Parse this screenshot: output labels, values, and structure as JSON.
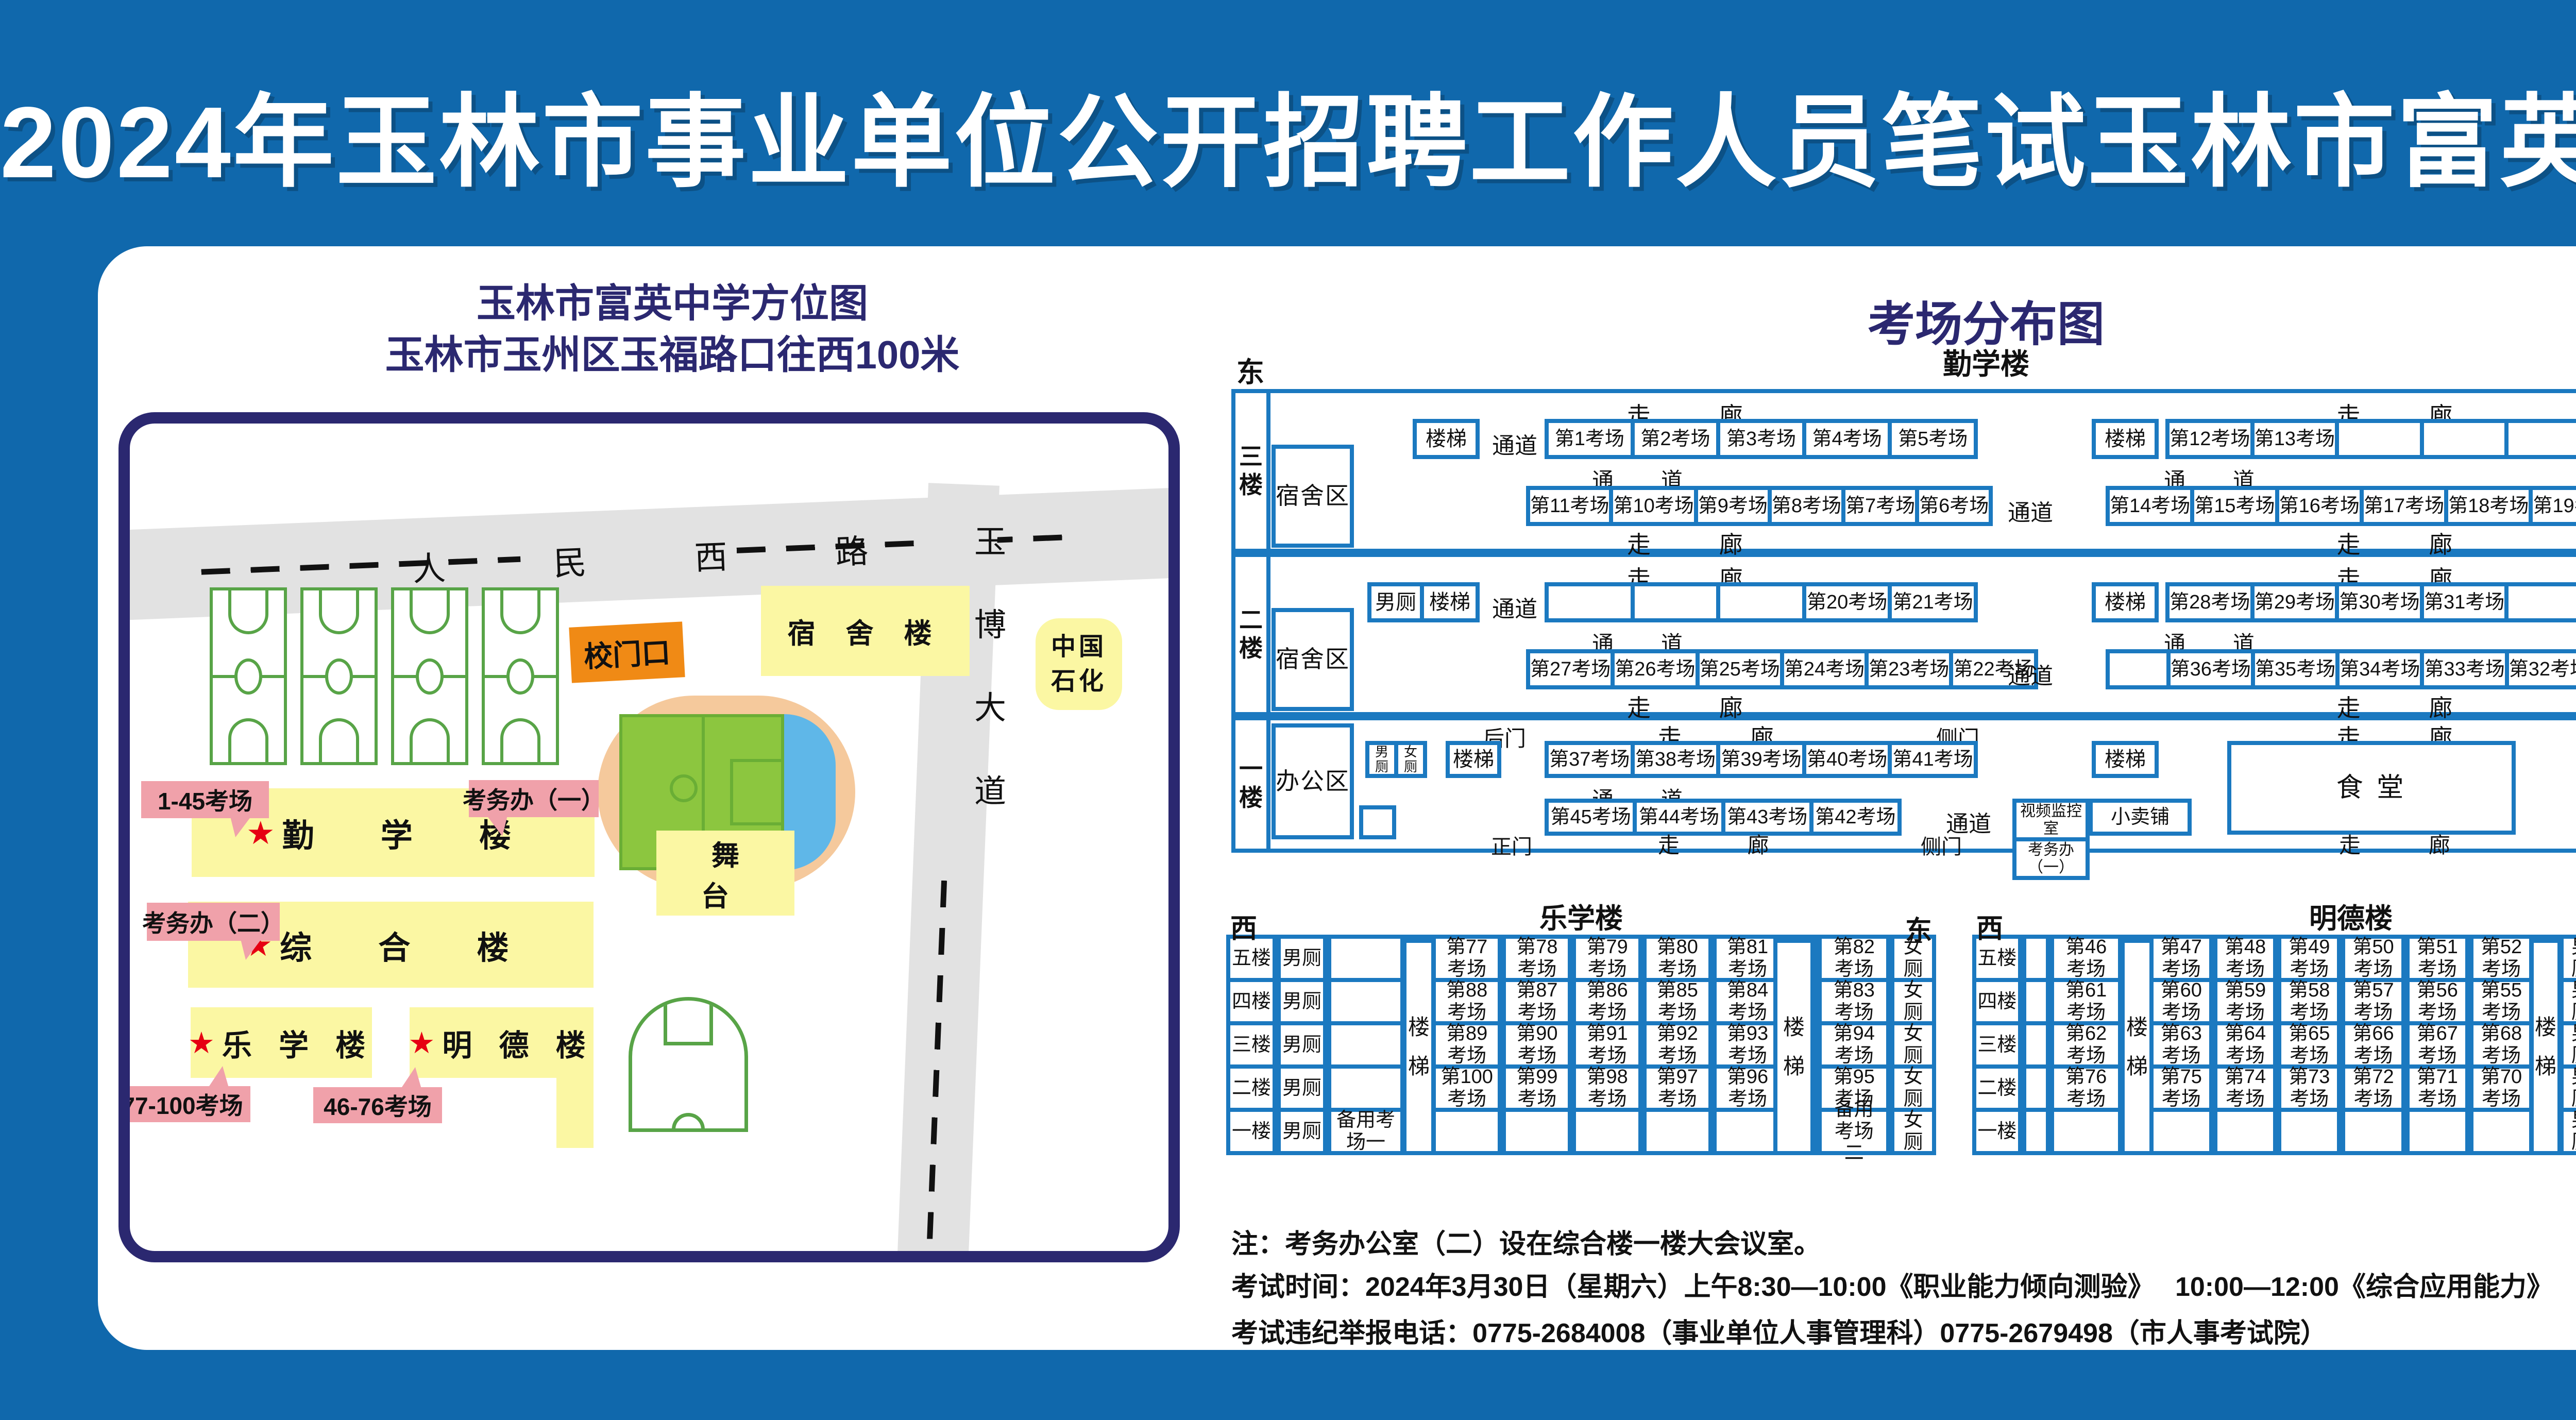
{
  "title": "2024年玉林市事业单位公开招聘工作人员笔试玉林市富英中学考点考场示意图",
  "left_map": {
    "title_line1": "玉林市富英中学方位图",
    "title_line2": "玉林市玉州区玉福路口往西100米",
    "road_ew": "人 民 西 路",
    "road_ns": "玉博大道",
    "gate": "校门口",
    "dorm": "宿 舍 楼",
    "sinopec": "中国石化",
    "stage": "舞 台",
    "star": "★",
    "buildings": {
      "qinxue": "勤 学 楼",
      "zonghe": "综 合 楼",
      "lexue": "乐 学 楼",
      "mingde": "明 德 楼"
    },
    "callouts": {
      "qinxue_rooms": "1-45考场",
      "kwb1": "考务办（一）",
      "kwb2": "考务办（二）",
      "lexue_rooms": "77-100考场",
      "mingde_rooms": "46-76考场"
    }
  },
  "plan": {
    "title": "考场分布图",
    "building": "勤学楼",
    "east": "东",
    "west": "西",
    "corridor": "走 廊",
    "passage": "通 道",
    "passage_small": "通道",
    "stairs": "楼梯",
    "male": "男厕",
    "female": "女厕",
    "f3": {
      "label": "三楼",
      "zone": "宿舍区",
      "top_left": [
        "第1考场",
        "第2考场",
        "第3考场",
        "第4考场",
        "第5考场"
      ],
      "top_right": [
        "第12考场",
        "第13考场",
        "",
        "",
        ""
      ],
      "bottom_left": [
        "第11考场",
        "第10考场",
        "第9考场",
        "第8考场",
        "第7考场",
        "第6考场"
      ],
      "bottom_right": [
        "第14考场",
        "第15考场",
        "第16考场",
        "第17考场",
        "第18考场",
        "第19考场"
      ]
    },
    "f2": {
      "label": "二楼",
      "zone": "宿舍区",
      "top_left": [
        "",
        "",
        "",
        "第20考场",
        "第21考场"
      ],
      "top_right": [
        "第28考场",
        "第29考场",
        "第30考场",
        "第31考场",
        ""
      ],
      "bottom_left": [
        "第27考场",
        "第26考场",
        "第25考场",
        "第24考场",
        "第23考场",
        "第22考场"
      ],
      "bottom_right": [
        "",
        "第36考场",
        "第35考场",
        "第34考场",
        "第33考场",
        "第32考场"
      ]
    },
    "f1": {
      "label": "一楼",
      "zone": "办公区",
      "top": [
        "第37考场",
        "第38考场",
        "第39考场",
        "第40考场",
        "第41考场"
      ],
      "bottom": [
        "第45考场",
        "第44考场",
        "第43考场",
        "第42考场"
      ],
      "canteen": "食  堂",
      "monitor": "视频监控室",
      "kwb1": "考务办（一）",
      "shop": "小卖铺",
      "back_door": "后门",
      "side_door": "侧门",
      "main_door": "正门"
    }
  },
  "tables": {
    "lexue": {
      "west": "西",
      "east": "东",
      "name": "乐学楼",
      "stairs": "楼梯",
      "rows": [
        {
          "floor": "五楼",
          "male": "男厕",
          "extra": "",
          "r0": "第77考场",
          "r1": "第78考场",
          "r2": "第79考场",
          "r3": "第80考场",
          "r4": "第81考场",
          "east": "第82考场",
          "female": "女厕"
        },
        {
          "floor": "四楼",
          "male": "男厕",
          "extra": "",
          "r0": "第88考场",
          "r1": "第87考场",
          "r2": "第86考场",
          "r3": "第85考场",
          "r4": "第84考场",
          "east": "第83考场",
          "female": "女厕"
        },
        {
          "floor": "三楼",
          "male": "男厕",
          "extra": "",
          "r0": "第89考场",
          "r1": "第90考场",
          "r2": "第91考场",
          "r3": "第92考场",
          "r4": "第93考场",
          "east": "第94考场",
          "female": "女厕"
        },
        {
          "floor": "二楼",
          "male": "男厕",
          "extra": "",
          "r0": "第100考场",
          "r1": "第99考场",
          "r2": "第98考场",
          "r3": "第97考场",
          "r4": "第96考场",
          "east": "第95考场",
          "female": "女厕"
        },
        {
          "floor": "一楼",
          "male": "男厕",
          "extra": "备用考场一",
          "r0": "",
          "r1": "",
          "r2": "",
          "r3": "",
          "r4": "",
          "east": "备用考场二",
          "female": "女厕"
        }
      ]
    },
    "mingde": {
      "west": "西",
      "east": "东",
      "name": "明德楼",
      "stairs": "楼梯",
      "rows": [
        {
          "floor": "五楼",
          "west_cell": "第46考场",
          "r0": "第47考场",
          "r1": "第48考场",
          "r2": "第49考场",
          "r3": "第50考场",
          "r4": "第51考场",
          "r5": "第52考场",
          "male": "男厕",
          "female": "女厕",
          "east": "第53考场"
        },
        {
          "floor": "四楼",
          "west_cell": "第61考场",
          "r0": "第60考场",
          "r1": "第59考场",
          "r2": "第58考场",
          "r3": "第57考场",
          "r4": "第56考场",
          "r5": "第55考场",
          "male": "男厕",
          "female": "女厕",
          "east": "第54考场"
        },
        {
          "floor": "三楼",
          "west_cell": "第62考场",
          "r0": "第63考场",
          "r1": "第64考场",
          "r2": "第65考场",
          "r3": "第66考场",
          "r4": "第67考场",
          "r5": "第68考场",
          "male": "男厕",
          "female": "女厕",
          "east": "第69考场"
        },
        {
          "floor": "二楼",
          "west_cell": "第76考场",
          "r0": "第75考场",
          "r1": "第74考场",
          "r2": "第73考场",
          "r3": "第72考场",
          "r4": "第71考场",
          "r5": "第70考场",
          "male": "男厕",
          "female": "女厕",
          "east": ""
        },
        {
          "floor": "一楼",
          "west_cell": "",
          "r0": "",
          "r1": "",
          "r2": "",
          "r3": "",
          "r4": "",
          "r5": "",
          "male": "男厕",
          "female": "女厕",
          "east": ""
        }
      ]
    }
  },
  "notes": [
    "注：考务办公室（二）设在综合楼一楼大会议室。",
    "考试时间：2024年3月30日（星期六）上午8:30—10:00《职业能力倾向测验》　 10:00—12:00《综合应用能力》",
    "考试违纪举报电话：0775-2684008（事业单位人事管理科）0775-2679498（市人事考试院）"
  ],
  "colors": {
    "bg": "#1068ac",
    "panel": "#ffffff",
    "navy": "#2b2870",
    "blue": "#1b79c0",
    "yellow": "#fbf7a3",
    "orange": "#f08a15",
    "pink": "#f0a1aa",
    "red": "#e60012",
    "gray": "#e2e2e2",
    "green": "#58a447",
    "track": "#f5c99c",
    "field": "#8cc63f",
    "water": "#5fb7e8",
    "ink": "#111111"
  }
}
